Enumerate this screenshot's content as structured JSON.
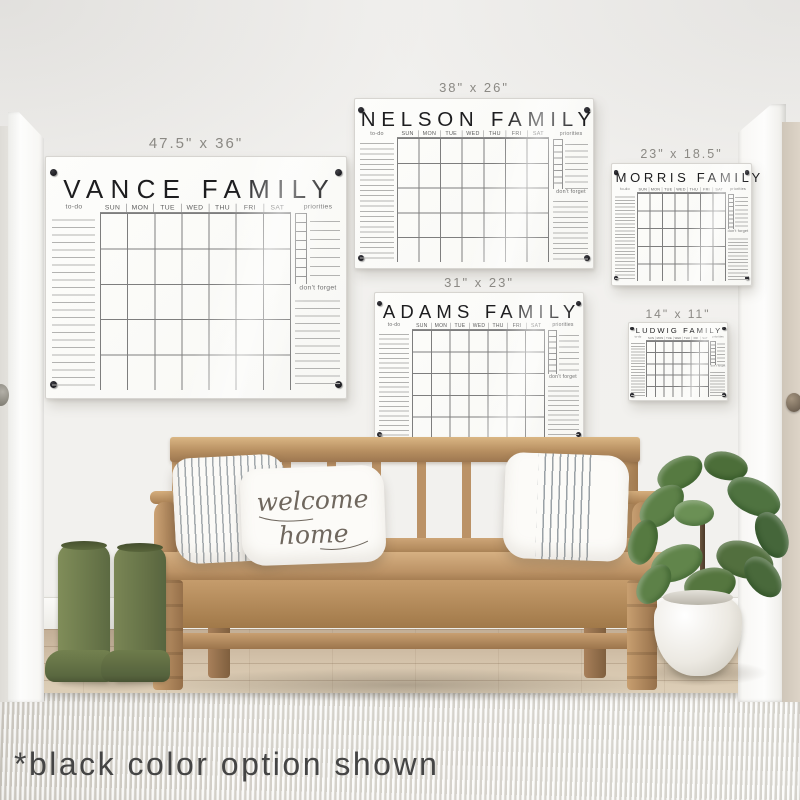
{
  "caption": "*black color option shown",
  "labels": {
    "todo": "to-do",
    "priorities": "priorities",
    "dont_forget": "don't forget"
  },
  "days": [
    "SUN",
    "MON",
    "TUE",
    "WED",
    "THU",
    "FRI",
    "SAT"
  ],
  "boards": [
    {
      "title": "VANCE FAMILY",
      "size_label": "47.5\" x 36\""
    },
    {
      "title": "NELSON FAMILY",
      "size_label": "38\" x 26\""
    },
    {
      "title": "ADAMS FAMILY",
      "size_label": "31\" x 23\""
    },
    {
      "title": "MORRIS FAMILY",
      "size_label": "23\" x 18.5\""
    },
    {
      "title": "LUDWIG FAMILY",
      "size_label": "14\" x 11\""
    }
  ],
  "pillow": {
    "line1": "welcome",
    "line2": "home"
  },
  "palette": {
    "wall": "#f0efec",
    "board": "#fcfcfa",
    "board_title": "#1d1d1f",
    "size_label": "#8b8984",
    "grid_line": "#7e7e7e",
    "note_line": "#b3b3b1",
    "standoff_dot": "#0e0e12",
    "bench_wood": "#bb9266",
    "boots": "#687549",
    "plant_leaves": "#55763f",
    "pot": "#ece9e2",
    "floor": "#d6c5ad",
    "rug": "#eae8e2",
    "door_right": "#d5ccbf",
    "caption": "#454545"
  }
}
